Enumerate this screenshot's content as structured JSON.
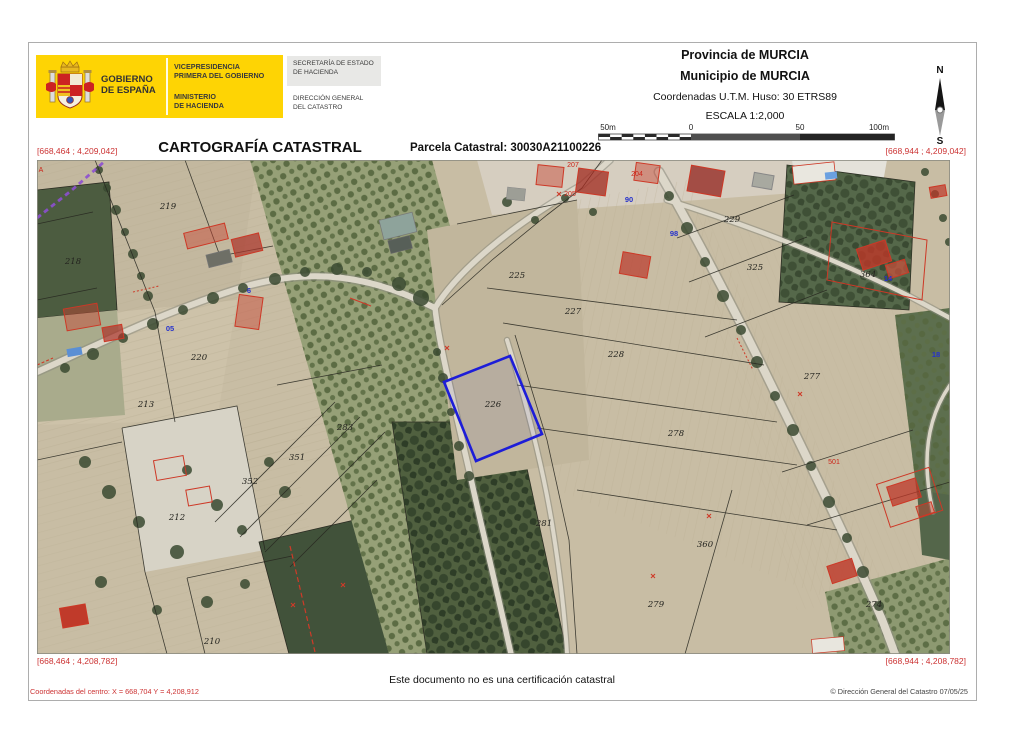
{
  "logo": {
    "gobierno": [
      "GOBIERNO",
      "DE ESPAÑA"
    ],
    "vicepresidencia": [
      "VICEPRESIDENCIA",
      "PRIMERA DEL GOBIERNO"
    ],
    "ministerio": [
      "MINISTERIO",
      "DE HACIENDA"
    ],
    "secretaria": [
      "SECRETARÍA DE ESTADO",
      "DE HACIENDA"
    ],
    "direccion": [
      "DIRECCIÓN GENERAL",
      "DEL CATASTRO"
    ]
  },
  "header": {
    "provincia": "Provincia de MURCIA",
    "municipio": "Municipio de MURCIA",
    "coordenadas": "Coordenadas U.T.M. Huso: 30 ETRS89",
    "escala": "ESCALA 1:2,000",
    "scale_labels": [
      "50m",
      "0",
      "50",
      "100m"
    ],
    "compass_n": "N",
    "compass_s": "S"
  },
  "title": {
    "main": "CARTOGRAFÍA CATASTRAL",
    "parcela": "Parcela Catastral: 30030A21100226"
  },
  "map": {
    "corner_top_left": "[668,464 ; 4,209,042]",
    "corner_top_right": "[668,944 ; 4,209,042]",
    "corner_bottom_left": "[668,464 ; 4,208,782]",
    "corner_bottom_right": "[668,944 ; 4,208,782]",
    "highlighted_parcel": "226",
    "highlight_color": "#1d1dd8",
    "parcel_labels": [
      {
        "text": "218"
      },
      {
        "text": "219"
      },
      {
        "text": "220"
      },
      {
        "text": "213"
      },
      {
        "text": "212"
      },
      {
        "text": "210"
      },
      {
        "text": "283"
      },
      {
        "text": "351"
      },
      {
        "text": "352"
      },
      {
        "text": "226"
      },
      {
        "text": "225"
      },
      {
        "text": "227"
      },
      {
        "text": "228"
      },
      {
        "text": "229"
      },
      {
        "text": "325"
      },
      {
        "text": "277"
      },
      {
        "text": "278"
      },
      {
        "text": "279"
      },
      {
        "text": "360"
      },
      {
        "text": "274"
      },
      {
        "text": "281"
      },
      {
        "text": "364"
      }
    ],
    "red_labels": [
      {
        "text": "A"
      },
      {
        "text": "207"
      },
      {
        "text": "204"
      },
      {
        "text": "205"
      },
      {
        "text": "501"
      }
    ],
    "blue_labels": [
      {
        "text": "90"
      },
      {
        "text": "98"
      },
      {
        "text": "6"
      },
      {
        "text": "14"
      },
      {
        "text": "18"
      },
      {
        "text": "05"
      }
    ]
  },
  "footer": {
    "disclaimer": "Este documento no es una certificación catastral",
    "center_coords": "Coordenadas del centro: X = 668,704 Y = 4,208,912",
    "copyright": "© Dirección General del Catastro 07/05/25"
  },
  "colors": {
    "logo_yellow": "#fed404",
    "accent_red": "#cc3333",
    "highlight_blue": "#1d1dd8",
    "zone_purple": "#8d4fd0"
  }
}
